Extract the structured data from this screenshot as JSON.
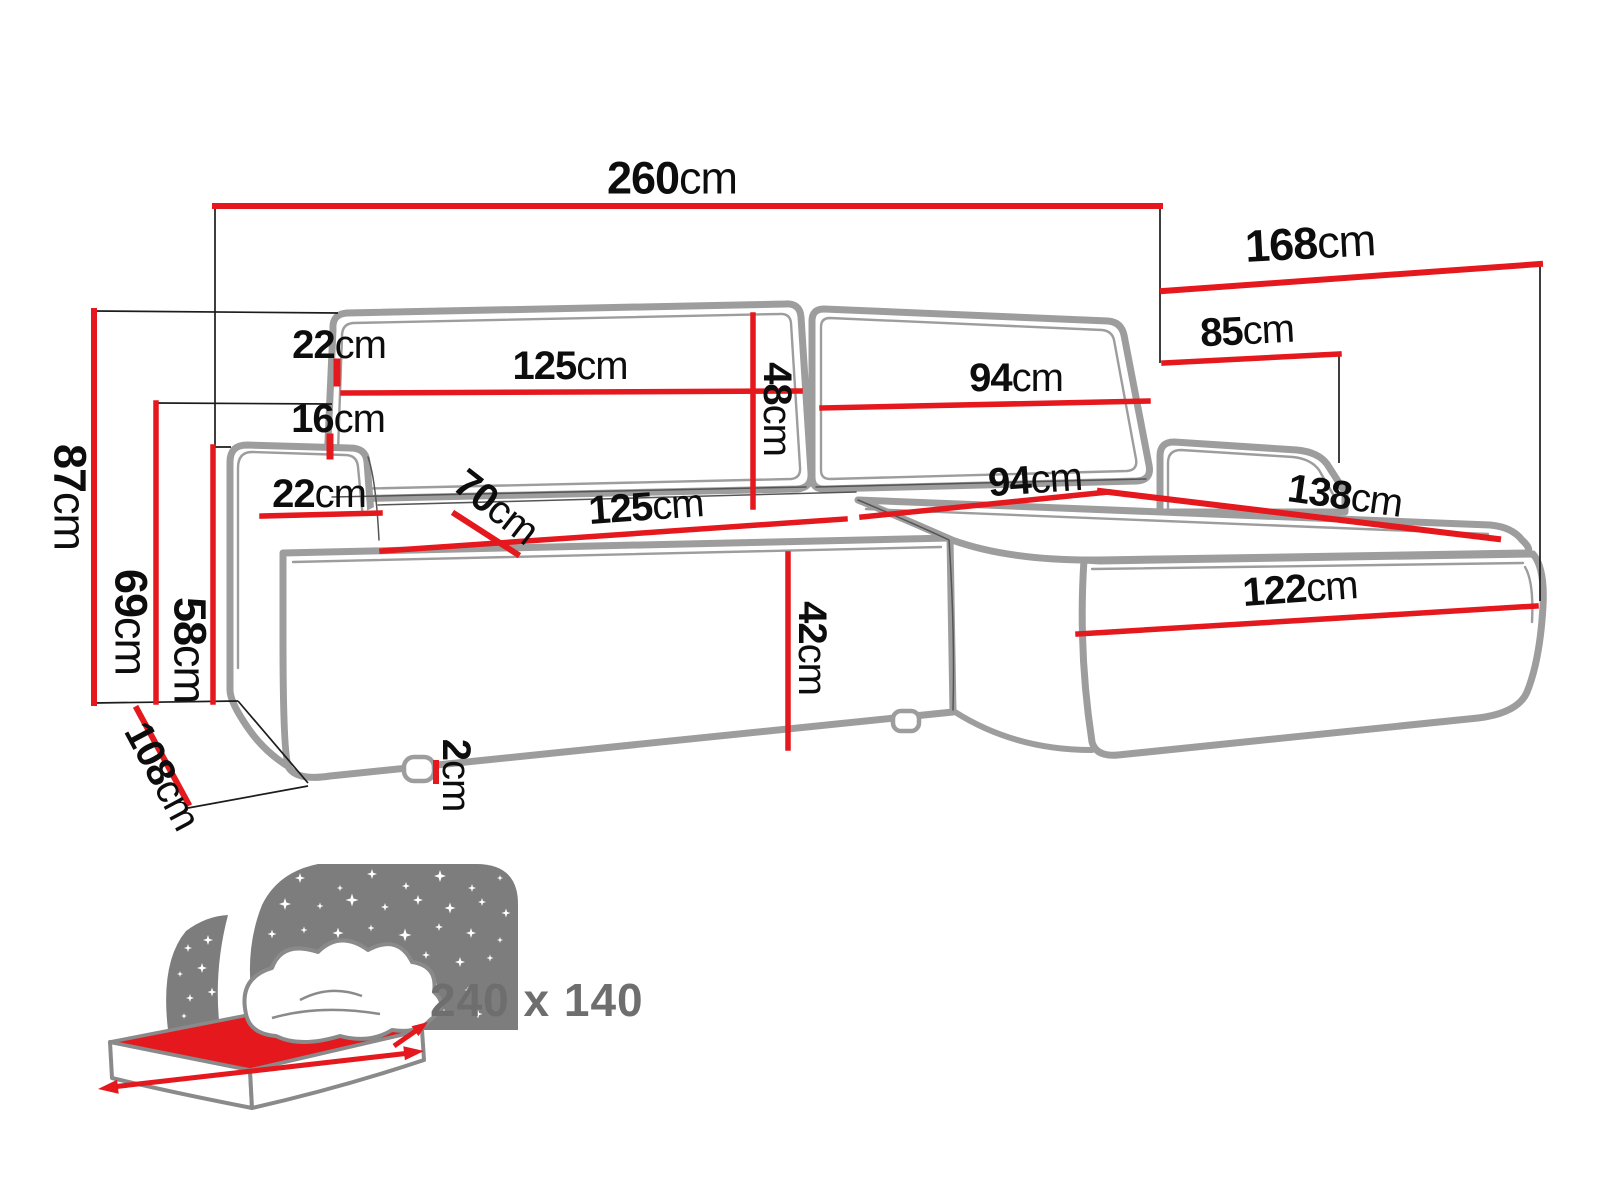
{
  "diagram_type": "corner-sofa-dimension-drawing",
  "dims": {
    "d260": {
      "value": "260",
      "unit": "cm"
    },
    "d168": {
      "value": "168",
      "unit": "cm"
    },
    "d85": {
      "value": "85",
      "unit": "cm"
    },
    "d87": {
      "value": "87",
      "unit": "cm"
    },
    "d69": {
      "value": "69",
      "unit": "cm"
    },
    "d58": {
      "value": "58",
      "unit": "cm"
    },
    "d108": {
      "value": "108",
      "unit": "cm"
    },
    "d22top": {
      "value": "22",
      "unit": "cm"
    },
    "d125top": {
      "value": "125",
      "unit": "cm"
    },
    "d48": {
      "value": "48",
      "unit": "cm"
    },
    "d94top": {
      "value": "94",
      "unit": "cm"
    },
    "d16": {
      "value": "16",
      "unit": "cm"
    },
    "d22low": {
      "value": "22",
      "unit": "cm"
    },
    "d70": {
      "value": "70",
      "unit": "cm"
    },
    "d125low": {
      "value": "125",
      "unit": "cm"
    },
    "d94low": {
      "value": "94",
      "unit": "cm"
    },
    "d138": {
      "value": "138",
      "unit": "cm"
    },
    "d42": {
      "value": "42",
      "unit": "cm"
    },
    "d122": {
      "value": "122",
      "unit": "cm"
    },
    "d2": {
      "value": "2",
      "unit": "cm"
    }
  },
  "bed": {
    "size_label": "240 x 140"
  },
  "colors": {
    "dimension_red": "#e4181d",
    "sofa_outline_grey": "#9d9d9d",
    "contour_dark": "#555555",
    "reference_line_black": "#1c1c1c",
    "icon_grey": "#7d7d7d",
    "icon_outline_grey": "#8a8a8a",
    "bed_size_text_grey": "#6e6e6e",
    "label_black": "#0d0d0d"
  }
}
